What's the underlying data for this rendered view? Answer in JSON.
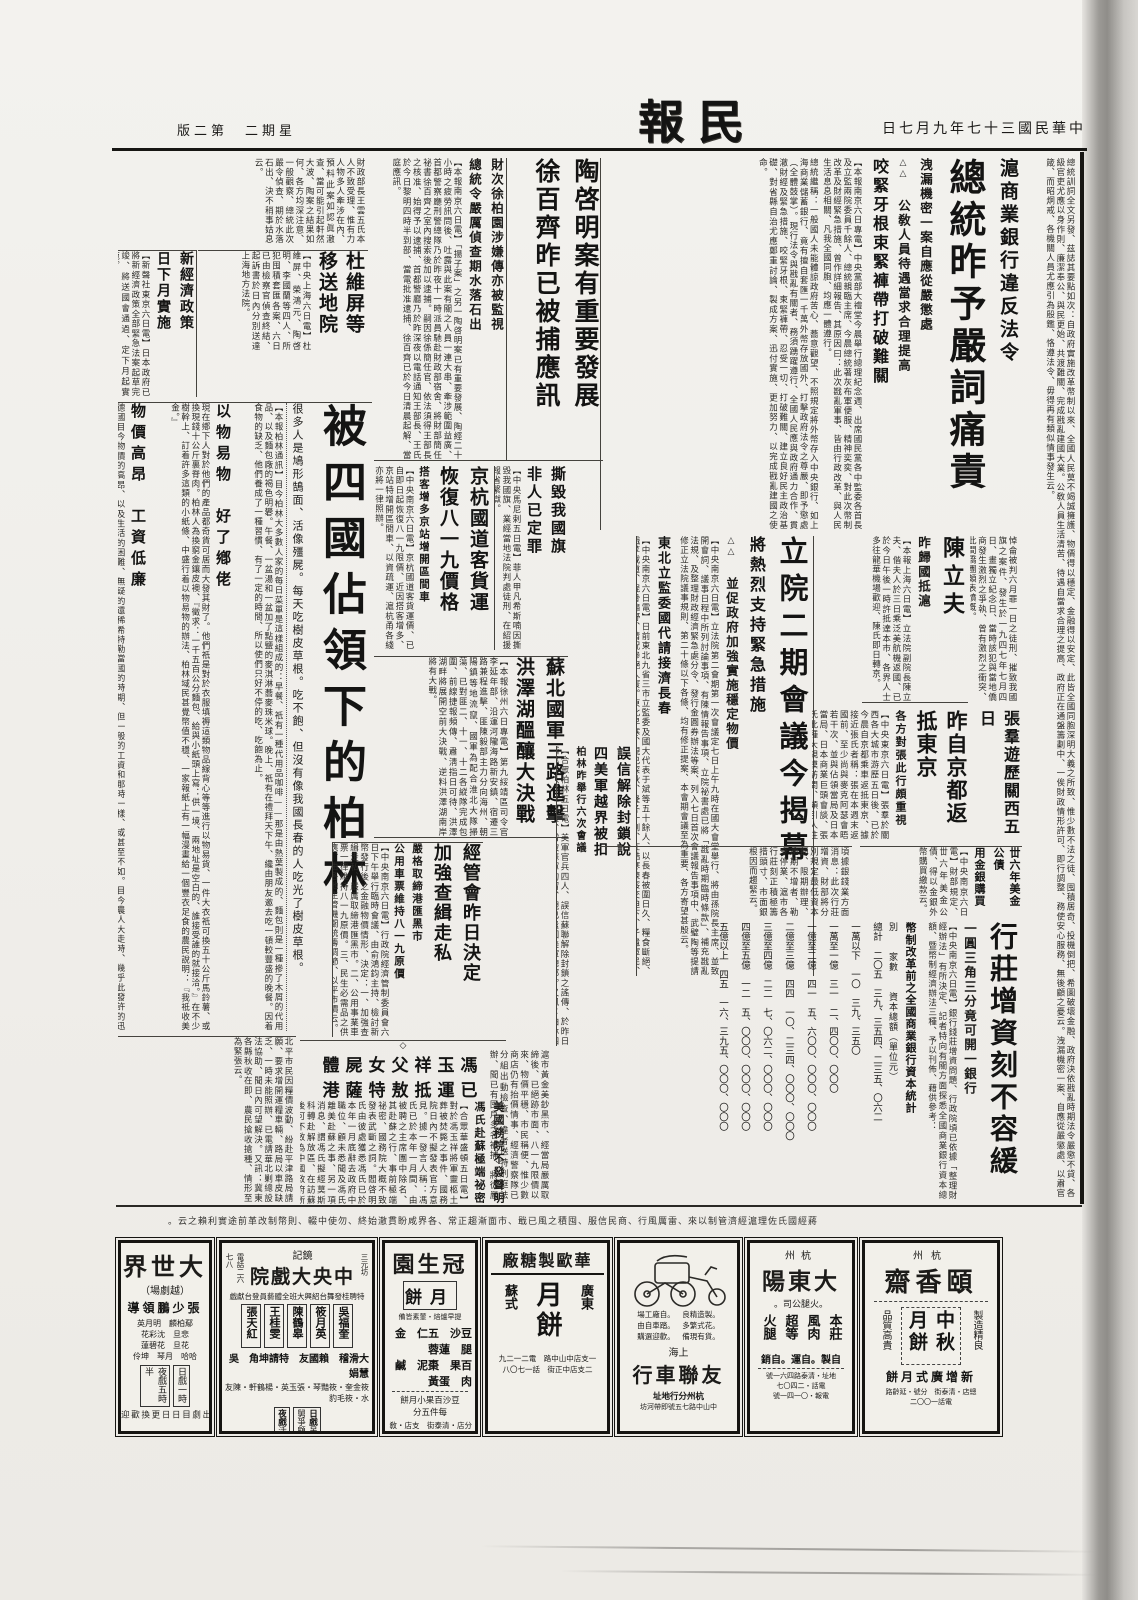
{
  "page": {
    "masthead": "民報",
    "date": "中華民國三十七年九月七日",
    "weekday_edition": "星期二　第二版"
  },
  "lead": {
    "kicker": "滬商業銀行違反法令",
    "headline": "總統昨予嚴詞痛責",
    "sub1": "洩漏機密一案自應從嚴懲處",
    "marks": "△△",
    "sub2": "公敎人員待遇當求合理提高",
    "sub3": "咬緊牙根束緊褲帶打破難關",
    "body1": "【本報南京六日專電】中央黨部大禮堂今晨舉行總理紀念週、出席國民黨各中監委各首長及立監兩院委員千餘人、總統親臨主席、今晨總統著灰布軍便服、精神奕奕、對此次幣制改革及財經緊急措施、曾作詳細報告、其原因曰：此次戡亂軍事、皆由行政改革、與人民生活息息相關、凡我全國同胞、均應一體遵行。",
    "body2": "總統繼稱：一般國人未能體諒政府苦心、蕎意觀望、不照規定將外幣存入中央銀行、如上海商業儲蓄銀行、竟有擅自套匯一千萬外幣存放國外、打擊政府法令之尊嚴、即予懲處（全體鼓掌）。現行法令與戡亂有關者、務須踴躍遵行、全國人民應與政府通力合作、貫澈財經及緊急措施、咬緊牙根、束緊褲帶、忍受一切、打破難關、建立良好民主政治基礎、對省縣自治尤應鄭重討論、製成方案、迅付實施、更加努力、以完成戡亂建國之使命。",
    "strip": "總統訓詞全文另發、茲誌其要點如次：自政府實施改革幣制以來、全國人民莫不竭誠擁護、物價得以穩定、金融得以安定、此皆全國同胞深明大義之所致、惟少數不法之徒、囤積居奇、投機倒把、希圖破壞金融、政府決依戡亂時期法令嚴懲不貸、各級官吏尤應以身作則、廉潔奉公、與民更始、共渡難關、完成戡亂建國大業。公敎人員生活清苦、待遇自當求合理之提高、政府正在通盤籌劃中、一俟財政情形許可、即行調整、務使安心服務、無後顧之憂云。洩漏機密一案、自應從嚴懲處、以肅官箴、而昭炯戒、各機關人員尤應引為殷鑑、恪遵法令、毋得再有類似情事發生云。"
  },
  "tao": {
    "h1": "陶啓明案有重要發展",
    "h2": "徐百齊昨已被捕應訊",
    "sub1": "財次徐柏園涉嫌傳亦被監視",
    "sub2": "總統令嚴厲偵查期水落石出",
    "body": "【本報南京六日電】「揚子案」之另一陶啓明案已有重要發展、陶經二十小時之疲勞訊問後、吐露與此案有關之人員一連大串、牽涉範圍益廣、首都警察廳刑警總隊乃於昨夜十一時派員馳赴財政部宿舍、將財部簡任祕書徐百齊之室內搜索後加以逮捕。嗣因徐係簡任官、依法須得王部長之核准、始得予以逮捕、首都警廳乃於昨深夜以電話通知王部長、王氏於今日黎明四時半到部、當電批准逮捕、徐百齊已於今日清晨起解、當庭應訊。"
  },
  "topleft_filler": "財政部長王雲五氏本人不致受理、惟有力人物多人牽涉在內、預料此案如認眞澈查、當可能引起軒然大波、陶案之結果如何、各方均深注意、一般觀察、總統此次嚴令偵查、期於水落石出、決不稍事姑息云。",
  "du": {
    "headline": "杜維屏等移送地院",
    "body": "【中央上海六日電】杜維屏、榮鴻元、陶啓明、李國蘭等四人、所犯囤積套匯各案、六日已由檢察官偵查終結、起訴書於日內分別送達上海地方法院。"
  },
  "econ_jp": {
    "h1": "新經濟政策",
    "h2": "日下月實施",
    "body": "【新聲社東京六日電】日本政府已將新經濟政策全部緊急法案起草完竣、將送國會通過、定下月起實施。"
  },
  "berlin": {
    "headline": "被四國佔領下的柏林",
    "lede": "很多人是鳩形鵠面、活像殭屍。每天吃樹皮草根。吃不飽、但沒有像我國長春的人吃光了樹皮草根。",
    "body1": "【本報柏林通訊】目今柏林大多數人家的每日菜單是這樣組成的：早餐、祇有一種代用品咖啡——那是由熱葉製成的、麵包則是一種摻了木屑的代用品、以及麵包廠的褐色明礬。午餐、一盆湯和一盆加了點鹽的麥淇淋蕎麥珠米球。晚上、祇有在禮拜天下午、纔由朋友邀去吃一頓較豐盛的晚餐。因着食物的缺乏、他們養成了一種習慣、有了一定的時間、所以使們只好不停的吃、吃飽為止。",
    "subA": "以物易物　好了鄕佬",
    "body2": "現在鄕下人對於他們的產品都奇貨可居而大發其財了。他們祇是對於衣服填褥這類物品線背心等等進行以物易貨、一件大衣祇可換五十公斤馬鈴薯、或換現錢十公斤裏脊肉。柏林人為換窮金鑲皮襖、『徵求：一千五百公分麵包、給與小紙頭上寫：供一境、兩地址是空白的、誰接受誰的就接洽。』在不少樹幹上、訂着許多這類的小紙條、中盛行着以物易物的辦法、柏林域民甚覺幣值不穩、一家報紙上有一幅漫畫給一個豐衣足食的農民說明：『我祗收美金。』",
    "subB": "物價高昂　工資低廉",
    "body3": "德國目今物價的高昂、以及生活的困難、無疑的還稀希特勒當國的時期、但一般的工資和那時一樣、或甚至不如。目今農人大走時、幾乎此發許的迅速、至於有專門技術的工人、則薪給苟延殘喘、和普通一樣、至於中級的工人亦祇勉強度日、令人驚呼負擔重、工資低廉已極。",
    "subC": "舊貨店裏　紀念品多",
    "body4": "凡是舊日的存貨、現在都是最最迎投機取巧的、柏林的時髦婦女存在銀行中保險箱裏的首飾、市上比比皆是、准許存戶領取。舊日一般人不堪設想的紀念品、今日在舊貨店裏觸目皆是、有某貴族馬路上擺列不少、奈何瞧不起眼的東西、也有大批靑年人、把他們那僅有的一點產業、都拿來換取食物了。貧窮的唯一原因、還要加上寒冷、去年夏天、一切的男女兒童、到購衣買鞋的記卡、祇能到四分之三的柏林人衣衫襤褸、在街上跑來跑去。"
  },
  "road": {
    "h1": "京杭國道客貨運",
    "h2": "恢復八一九價格",
    "sub": "搭客增多京站增開區間車",
    "body": "【中央南京六日電】京杭國道客貨運價、已自即日起恢復八一九限價、近因搭客增多、京站特增開區間車、以資疏運、滬杭甬各綫亦將一律照辦。"
  },
  "flag": {
    "h1": "撕毀我國旗",
    "h2": "非人已定罪",
    "body": "【中央馬尼剌五日電】菲人甲凡希斯喃因撕毀我國旗、業經當地法院判處徒刑、在紹援報省繫獄。"
  },
  "ly": {
    "headline": "立院二期會議今揭幕",
    "sub1": "將熱烈支持緊急措施",
    "marks": "△△",
    "sub2": "並促政府加強實施穩定物價",
    "body": "【中央南京六日電】立法院第二會期第一次會議定七日上午九時在國大會堂舉行、將由孫院長主席、並致開會詞、議事日程中所列討論事項、有陳情報告事項、立院祕書處已將「戡亂時期臨時條款」、補充戡亂法規、及整理財政經濟緊急處分令、發行金圓券辦法等案、列入七日首次會議報告事項中、武璧陶等提請修正立法院議事規則、第二十條以下各條、均有修正提案、本會期會議至為重要、各方寄望甚殷云。",
    "ne_head": "東北立監委國代請接濟長春",
    "ne_body": "【中央南京六日電】日前東北九省三市立監委及國大代表于斌等五十餘人、以長春被圍日久、糧食斷絕、餓莩載道、屍骨遍野、情況慘絕人寰。東北早寒、現已深秋、隆冬一到、在酷寒凍餒交迫下、孑遺軍民、縱不餓死、亦必凍死、聯名呈請政府、火速設法救濟、空投食糧、以慰民望。"
  },
  "chen": {
    "headline": "陳立夫",
    "sub": "昨歸國抵滬",
    "body": "【本報上海六日電】立法院副院長陳立夫、偕夫人於三日乘泛美航機返國、已於今日午後一時許抵達本市、各界人士多往龍華機場歡迎、陳氏即日轉京。"
  },
  "chen_side": "悼侖被判六月罪一日之徒刑、摧致我國旗之案件、發生於一九四七年七月四日、畫獨立紀念日、當時該犯與當地僑商發生激烈之爭執、曾有激烈之衝突、此間僑團頗表憤慨。",
  "zhang": {
    "h1": "張羣遊歷關西五日",
    "h2": "昨自京都返抵東京",
    "sub": "各方對張此行頗重視",
    "body": "【中央東京六日電】張羣於關西各大城市游歷五日後、已於今晨自京都乘車返抵東京、據接近張氏者稱：張在本週末返國前、至少尚與麥克阿瑟會晤若干次、並與佔領當局及日本當局、日本商業巨頭會談、張氏此種大規模訪問、頗引人注目、彼等均係以私人資格與張氏會晤、花園舉行茶會、歡迎陳氏、並將陳氏訪問經過情形、以及我方撫慰之經過、報告各界、各方對張氏此行頗為重視。"
  },
  "bond": {
    "h1": "丗六年美金公債",
    "h2": "用金銀購買",
    "body": "【中央南京六日電】財部規定、丗六年美金公債、得以金銀外幣購買繳款云。"
  },
  "subei": {
    "h1": "蘇北國軍三路進擊",
    "h2": "洪澤湖醞釀大決戰",
    "body": "【本報徐州六日專電】第九綏靖區司令官李延年部、沿運河隴海路新安鎮、宿遷三路兼程進擊、匪陳毅部主力分向海州、朝陽鎮等地流竄、國軍為配合淮北大隊掃蕩、已對匪二、十一、十二各縱隊完成包圍、前線捷報頻傳、肅淸指日可待、洪澤湖畔將展開空前大決戰、逆料洪澤湖南岸將有大戰。"
  },
  "berlin4": {
    "h1": "誤信解除封鎖說",
    "h2": "四美軍越界被扣",
    "sub": "柏林昨舉行六次會議",
    "body": "【合眾柏林五日電】美軍官兵四人、誤信蘇聯解除封鎖之謠傳、於昨日越界進入蘇軍防區、當被蘇軍拘留、現已遣回美軍總部。又訊：柏林四國軍事當局昨舉行第六次會議、蘇方對貨幣問題仍未讓步、會議結果尚未可知、英美法三方代表會後均未發表談話。"
  },
  "smuggle": {
    "h1": "經管會昨日決定",
    "h2": "加強查緝走私",
    "sub1": "嚴格取締港匯黑市",
    "sub2": "公用車票維持八一九原價",
    "body": "【中央南京六日電】行政院經濟管制委員會六日下午舉行臨時會議、由俞鴻鈞主持、檢討新幣發行後之金融物價情形、決定：一、加強查緝走私、嚴厲取締港匯黑市。二、公用事業車票一律維持八一九原價。三、民生必需品之供應、由各地主管機關統籌調節、以平市價云。"
  },
  "mid_filler": "滬市黃金美鈔黑市、經當局嚴厲取締後、已絕跡市面、八一九限價以來、物價平穩、市民稱便、惟少數商店仍有抬價情事、經濟警察隊已分組出動檢查、違者送特刑庭法辦、聞已有囤戶多名被捕、將從嚴究辦、以儆效尤云。",
  "feng": {
    "mark": "◇",
    "h1": "馮玉祥父女屍體",
    "h2": "已運抵敖特薩港",
    "sub1": "美國務院不發聲明",
    "sub2": "馮氏赴蘇極端祕密",
    "body": "【合眾華盛頓五日電】對於馮玉祥將軍靈柩土葬被焚斃之事件、國務院日內不擬發表官方意見。據一發言人稱：馮氏已於本年一月間、由被聘之主席團中除名、其赴蘇之行、事前極端祕密、國務院大概不致發表武斷之詞。閻啓明氏由彼處獲悉馮氏已於本年一月底辭去政府中職位、顧未悉聞及馮氏離美赴蘇之事、另一項消息、謂馮氏擬經莫斯科轉赴解放區、在訪蘇後可不致為中國政府所逮捕、馮氏家屬現仍留美云。"
  },
  "bank": {
    "h1": "行莊增資刻不容緩",
    "sub": "一圓三角三分竟可開一銀行",
    "body": "【中央南京六日電】銀行錢莊增資問題、行政院頃已依據「整理財經辦法」有所決定、記者特向有關方面探悉全國商業銀行資本總額、暨幣制經濟辦法三種、予以刊佈、藉供參考：",
    "table_title": "幣制改革前之全國商業銀行資本統計",
    "headers": "別　　家數　　資本總額（單位元）",
    "row_total": "總計　二〇五　三九、三五四、二三五、〇六二",
    "row1": "一萬以下　一〇　三九、三五〇",
    "row2": "一萬至一億　三一　二、四〇〇、〇〇〇",
    "row3": "一億至二億　四一　五、六〇〇、〇〇〇、〇〇〇",
    "row4": "二億至三億　四四　一〇、二三四、〇〇〇、〇〇〇",
    "row5": "三億至四億　二二　七、〇六二、〇〇〇、〇〇〇",
    "row6": "四億至五億　一二　五、〇〇〇、〇〇〇、〇〇〇",
    "row7": "五億以上　四五　一六、三九五、〇〇〇、〇〇〇",
    "above": "頃據銀錢業方面消息：此次行莊增資、財部將分別規定最低資本額、限期辦理、逾期不增者、勒令停業、滬市各行莊刻正積極籌措頭寸、市面銀根因而趨緊云。"
  },
  "bottomleft_filler": "北平市民因糧價波動、紛赴平津路局請願、要求增開運糧車輛、路局以車皮缺乏、一時未能照辦、已電請華北剿總設法協助、聞日內可望解決。又訊：冀東各縣秋收在即、農民搶收搶種、情形至為緊張云。",
  "bottom_strip": "蔣經國氏佐理滬經濟管制以來、雷厲風行、商民信服、囤積之風已戢、市面漸趨正常、各界咸盼貫澈始終、勿使中輟、則幣制改革前途實利賴之云。",
  "ads": {
    "dashijie": {
      "name": "大世界",
      "subtitle": "（越劇場）",
      "director": "張少鵬領導",
      "cast1": "鄢柏麟　明月英",
      "cast2": "悲旦　沈彩花",
      "cast3": "花旦　花碧蓮",
      "cast4": "哈哈　月琴　坤伶",
      "day_label": "日戲",
      "day_time": "一時",
      "night_label": "夜戲",
      "night_time": "五時半",
      "note": "本院演員自本日起出劇目日日更換歡迎各界人士蒞臨指敎"
    },
    "zhongyang": {
      "tag": "鏡記",
      "name": "中央大戲院",
      "addr": "三元坊",
      "phone": "電話二六七八",
      "banner": "特聘桂發舞台紹興大班全體藝員登台獻戲",
      "star1": "吳福奎",
      "star2": "筱月英",
      "star3": "陳鶴皋",
      "star4": "王桂雯",
      "star5": "張天紅",
      "special": "大滑稽　賴國友　特請坤角　吳慧娟",
      "row3": "筱金奎・筱豔琴・張玉英・楊鶴軒・陳友水・筱毛豹",
      "day_label": "日戲",
      "day_show": "吊打國舅爭顧鼎臣",
      "night_label": "夜戲",
      "night_show": "活財神"
    },
    "guanshengyuan": {
      "name": "冠生園",
      "product": "月餅",
      "tagline": "提早爐焙・葷素皆備",
      "items1": "豆沙　五仁　金腿　蓮蓉",
      "items2": "百果　棗泥　鹹肉　蛋黃",
      "small": "豆沙百果小月餅",
      "price": "每件五分",
      "branches": "分店・清泰街　支店・敎仁橋"
    },
    "huaou": {
      "name": "華歐製糖廠",
      "style1": "廣東",
      "style2": "蘇式",
      "product": "月餅",
      "line1": "一支店中山中路　電二一二九",
      "line2": "二支店中正街　話一七〇八"
    },
    "youlian": {
      "bullets1": "。製造精良　。自廠工場",
      "bullets2": "。花式繁多　。踏車自由",
      "bullets3": "。貨有現備　。歡迎選購",
      "city": "上海",
      "name": "友聯車行",
      "footer1": "杭州分行地址",
      "footer2": "中山中路七五號即帶河坊"
    },
    "dadongyang": {
      "region": "杭州",
      "name": "大東陽",
      "subtitle": "。火腿公司。",
      "p1": "本莊",
      "p2": "風肉",
      "p3": "超等",
      "p4": "火腿",
      "line": "自製。自運。自銷",
      "addr": "地址・清泰路四六一號",
      "phone": "電話・二四〇七",
      "wire": "電報・〇一四一號"
    },
    "yixiangzhai": {
      "region": "杭州",
      "name": "頤香齋",
      "right_tag": "製造精良",
      "left_tag": "品質高貴",
      "product": "中秋月餅",
      "bottom": "新增廣式月餅",
      "footer1": "總店・清泰街　分號・延齡路",
      "footer2": "電話一〇〇二"
    }
  }
}
